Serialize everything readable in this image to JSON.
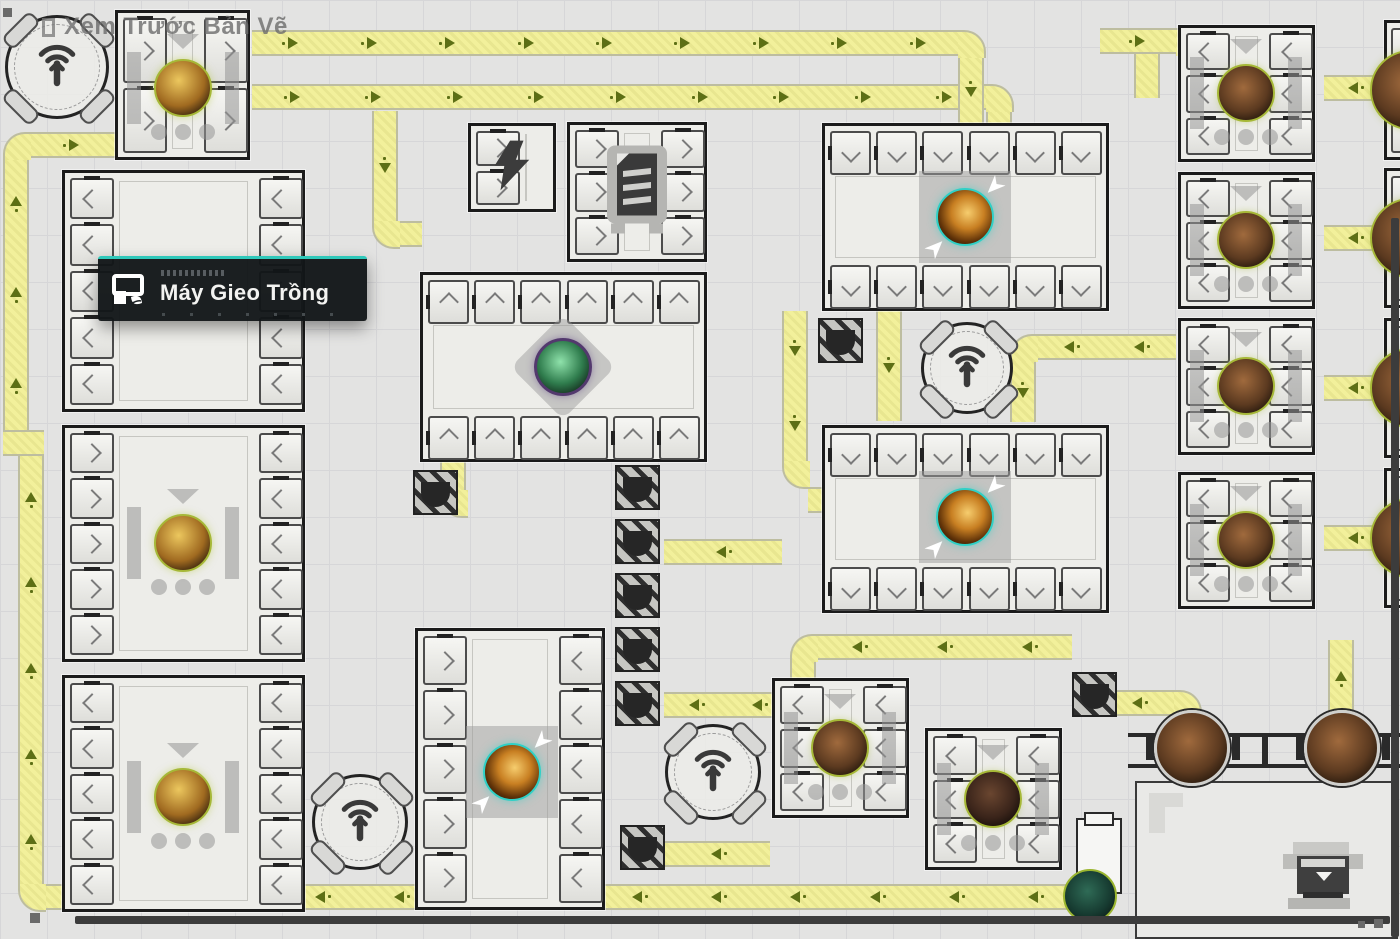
{
  "header": {
    "title": "Xem Trước Bản Vẽ"
  },
  "tooltip": {
    "label": "Máy Gieo Trồng",
    "accent": "#2fc8ba",
    "x": 98,
    "y": 256,
    "w": 240,
    "h": 62
  },
  "colors": {
    "background": "#e3e3e2",
    "grid": "#d6d6d8",
    "belt": "#f2f09b",
    "belt_edge": "#bdbda0",
    "arrow": "#5d6f15",
    "machine_fill": "#edede9",
    "machine_border": "#1b1b1b",
    "accent_teal": "#2fc8ba",
    "item_ring_olive": "#a6b837",
    "scrollbar": "#3c3c3c"
  },
  "icons": [
    "signal-antenna-icon",
    "lift-tunnel-icon",
    "lightning-icon",
    "furnace-icon",
    "printer-icon",
    "planter-leaf-icon"
  ],
  "map": {
    "belts_h": [
      {
        "x": 252,
        "y": 30,
        "len": 706,
        "d": "r"
      },
      {
        "x": 252,
        "y": 84,
        "len": 734,
        "d": "r"
      },
      {
        "x": 29,
        "y": 132,
        "len": 86,
        "d": "r"
      },
      {
        "x": 398,
        "y": 221,
        "len": 24,
        "d": "r"
      },
      {
        "x": 1324,
        "y": 75,
        "len": 62,
        "d": "l"
      },
      {
        "x": 1324,
        "y": 225,
        "len": 62,
        "d": "l"
      },
      {
        "x": 1324,
        "y": 375,
        "len": 62,
        "d": "l"
      },
      {
        "x": 1324,
        "y": 525,
        "len": 62,
        "d": "l"
      },
      {
        "x": 1036,
        "y": 334,
        "len": 140,
        "d": "l"
      },
      {
        "x": 808,
        "y": 487,
        "len": 30,
        "d": "l"
      },
      {
        "x": 664,
        "y": 539,
        "len": 118,
        "d": "l"
      },
      {
        "x": 664,
        "y": 692,
        "len": 126,
        "d": "l"
      },
      {
        "x": 816,
        "y": 634,
        "len": 256,
        "d": "l"
      },
      {
        "x": 665,
        "y": 841,
        "len": 105,
        "d": "l"
      },
      {
        "x": 44,
        "y": 884,
        "len": 1031,
        "d": "l"
      },
      {
        "x": 1104,
        "y": 690,
        "len": 70,
        "d": "l"
      },
      {
        "x": 1100,
        "y": 28,
        "len": 76,
        "d": "r"
      },
      {
        "x": 3,
        "y": 430,
        "len": 41,
        "d": "r"
      }
    ],
    "belts_v": [
      {
        "x": 958,
        "y": 56,
        "len": 67,
        "d": "d"
      },
      {
        "x": 986,
        "y": 110,
        "len": 13,
        "d": "d"
      },
      {
        "x": 3,
        "y": 158,
        "len": 272,
        "d": "u"
      },
      {
        "x": 18,
        "y": 456,
        "len": 428,
        "d": "u"
      },
      {
        "x": 372,
        "y": 111,
        "len": 110,
        "d": "d"
      },
      {
        "x": 876,
        "y": 311,
        "len": 110,
        "d": "d"
      },
      {
        "x": 1010,
        "y": 360,
        "len": 62,
        "d": "d"
      },
      {
        "x": 782,
        "y": 311,
        "len": 150,
        "d": "d"
      },
      {
        "x": 790,
        "y": 660,
        "len": 32,
        "d": "d"
      },
      {
        "x": 1174,
        "y": 716,
        "len": 16,
        "d": "d"
      },
      {
        "x": 1328,
        "y": 640,
        "len": 76,
        "d": "u"
      },
      {
        "x": 1134,
        "y": 54,
        "len": 44,
        "d": "d"
      },
      {
        "x": 440,
        "y": 462,
        "len": 28,
        "d": "d"
      }
    ],
    "corners": [
      {
        "x": 958,
        "y": 30,
        "rc": "tr"
      },
      {
        "x": 986,
        "y": 84,
        "rc": "tr"
      },
      {
        "x": 3,
        "y": 132,
        "rc": "tl"
      },
      {
        "x": 372,
        "y": 221,
        "rc": "bl"
      },
      {
        "x": 1010,
        "y": 334,
        "rc": "tl"
      },
      {
        "x": 782,
        "y": 461,
        "rc": "bl"
      },
      {
        "x": 790,
        "y": 634,
        "rc": "tl"
      },
      {
        "x": 790,
        "y": 692,
        "rc": "tr"
      },
      {
        "x": 18,
        "y": 884,
        "rc": "bl"
      },
      {
        "x": 1174,
        "y": 690,
        "rc": "tr"
      },
      {
        "x": 1176,
        "y": 28,
        "rc": "tr"
      },
      {
        "x": 440,
        "y": 490,
        "rc": "bl"
      }
    ],
    "machines": [
      {
        "id": "planter-1",
        "x": 115,
        "y": 10,
        "w": 135,
        "h": 150,
        "l": 2,
        "r": 2,
        "cl": "r",
        "cr": "r",
        "item": {
          "t": "gold",
          "cx": 183,
          "cy": 88
        },
        "deco": "plant"
      },
      {
        "id": "chamber-1",
        "x": 62,
        "y": 170,
        "w": 243,
        "h": 242,
        "l": 5,
        "r": 5,
        "cl": "l",
        "cr": "l"
      },
      {
        "id": "planter-2",
        "x": 62,
        "y": 425,
        "w": 243,
        "h": 237,
        "l": 5,
        "r": 5,
        "cl": "r",
        "cr": "l",
        "item": {
          "t": "gold",
          "cx": 183,
          "cy": 543
        },
        "deco": "plant"
      },
      {
        "id": "planter-3",
        "x": 62,
        "y": 675,
        "w": 243,
        "h": 237,
        "l": 5,
        "r": 5,
        "cl": "l",
        "cr": "l",
        "item": {
          "t": "gold",
          "cx": 183,
          "cy": 797
        },
        "deco": "plant"
      },
      {
        "id": "power-node",
        "x": 468,
        "y": 123,
        "w": 88,
        "h": 89,
        "l": 2,
        "cl": "r",
        "icon": "bolt"
      },
      {
        "id": "furnace",
        "x": 567,
        "y": 122,
        "w": 140,
        "h": 140,
        "l": 3,
        "r": 3,
        "cl": "r",
        "cr": "r",
        "icon": "furnace"
      },
      {
        "id": "grow-chamber",
        "x": 420,
        "y": 272,
        "w": 287,
        "h": 190,
        "t": 6,
        "b": 6,
        "ct": "u",
        "cb": "u",
        "item": {
          "t": "green",
          "cx": 563,
          "cy": 367
        },
        "deco": "diamond"
      },
      {
        "id": "collector-1",
        "x": 822,
        "y": 123,
        "w": 287,
        "h": 188,
        "t": 6,
        "b": 6,
        "ct": "d",
        "cb": "d",
        "item": {
          "t": "amber",
          "cx": 965,
          "cy": 217
        },
        "deco": "collect"
      },
      {
        "id": "collector-2",
        "x": 822,
        "y": 425,
        "w": 287,
        "h": 188,
        "t": 6,
        "b": 6,
        "ct": "d",
        "cb": "d",
        "item": {
          "t": "amber",
          "cx": 965,
          "cy": 517
        },
        "deco": "collect"
      },
      {
        "id": "planter-r1",
        "x": 1178,
        "y": 25,
        "w": 137,
        "h": 137,
        "l": 3,
        "r": 3,
        "cl": "l",
        "cr": "l",
        "item": {
          "t": "rock",
          "cx": 1246,
          "cy": 93
        },
        "deco": "plant"
      },
      {
        "id": "planter-r2",
        "x": 1178,
        "y": 172,
        "w": 137,
        "h": 137,
        "l": 3,
        "r": 3,
        "cl": "l",
        "cr": "l",
        "item": {
          "t": "rock",
          "cx": 1246,
          "cy": 240
        },
        "deco": "plant"
      },
      {
        "id": "planter-r3",
        "x": 1178,
        "y": 318,
        "w": 137,
        "h": 137,
        "l": 3,
        "r": 3,
        "cl": "l",
        "cr": "l",
        "item": {
          "t": "rock",
          "cx": 1246,
          "cy": 386
        },
        "deco": "plant"
      },
      {
        "id": "planter-r4",
        "x": 1178,
        "y": 472,
        "w": 137,
        "h": 137,
        "l": 3,
        "r": 3,
        "cl": "l",
        "cr": "l",
        "item": {
          "t": "rock",
          "cx": 1246,
          "cy": 540
        },
        "deco": "plant"
      },
      {
        "id": "collector-3",
        "x": 415,
        "y": 628,
        "w": 190,
        "h": 282,
        "l": 5,
        "r": 5,
        "cl": "r",
        "cr": "l",
        "item": {
          "t": "amber",
          "cx": 512,
          "cy": 772
        },
        "deco": "collect"
      },
      {
        "id": "planter-b1",
        "x": 772,
        "y": 678,
        "w": 137,
        "h": 140,
        "l": 3,
        "r": 3,
        "cl": "l",
        "cr": "l",
        "item": {
          "t": "rock",
          "cx": 840,
          "cy": 748
        },
        "deco": "plant"
      },
      {
        "id": "planter-b2",
        "x": 925,
        "y": 728,
        "w": 137,
        "h": 142,
        "l": 3,
        "r": 3,
        "cl": "l",
        "cr": "l",
        "item": {
          "t": "rock2",
          "cx": 993,
          "cy": 799
        },
        "deco": "plant"
      }
    ],
    "edge_machines": [
      {
        "y": 20,
        "h": 140,
        "cy": 90
      },
      {
        "y": 168,
        "h": 140,
        "cy": 238
      },
      {
        "y": 318,
        "h": 140,
        "cy": 388
      },
      {
        "y": 468,
        "h": 140,
        "cy": 538
      }
    ],
    "antennas": [
      {
        "cx": 57,
        "cy": 67,
        "d": 104
      },
      {
        "cx": 967,
        "cy": 368,
        "d": 92
      },
      {
        "cx": 713,
        "cy": 772,
        "d": 96
      },
      {
        "cx": 360,
        "cy": 822,
        "d": 96
      }
    ],
    "lifts": [
      [
        818,
        318
      ],
      [
        413,
        470
      ],
      [
        615,
        465
      ],
      [
        615,
        519
      ],
      [
        615,
        573
      ],
      [
        615,
        627
      ],
      [
        615,
        681
      ],
      [
        1072,
        672
      ],
      [
        620,
        825
      ]
    ],
    "rail": {
      "x": 1128,
      "y1": 733,
      "y2": 764,
      "w": 272,
      "cy": 748,
      "circles": [
        1192,
        1342
      ]
    },
    "loose_items": [
      {
        "t": "teal",
        "cx": 1090,
        "cy": 896,
        "d": 54
      }
    ],
    "whitebox": {
      "x": 1076,
      "y": 818,
      "w": 46,
      "h": 76
    },
    "br_zone": {
      "x": 1135,
      "y": 781,
      "w": 263,
      "h": 158
    },
    "printer": {
      "x": 1283,
      "y": 842
    },
    "scrollbars": {
      "h": {
        "x": 75,
        "y": 916,
        "w": 1315,
        "h": 8
      },
      "v": {
        "x": 1391,
        "y": 218,
        "w": 8,
        "h": 719
      }
    },
    "dots": [
      {
        "x": 3,
        "y": 8,
        "s": 9
      },
      {
        "x": 30,
        "y": 913,
        "s": 10
      },
      {
        "x": 1374,
        "y": 919,
        "s": 9
      },
      {
        "x": 1358,
        "y": 921,
        "s": 7
      }
    ]
  }
}
